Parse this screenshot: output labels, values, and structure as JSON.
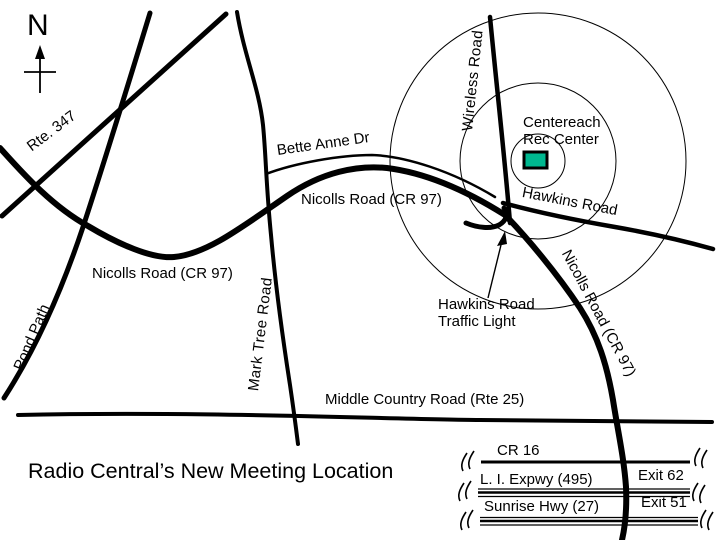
{
  "title": "Radio Central’s New Meeting Location",
  "compass": {
    "north_label": "N"
  },
  "roads": {
    "rte_347": "Rte. 347",
    "pond_path": "Pond Path",
    "mark_tree": "Mark Tree Road",
    "bette_anne": "Bette Anne Dr",
    "nicolls_west": "Nicolls Road (CR 97)",
    "nicolls_center": "Nicolls Road (CR 97)",
    "nicolls_south": "Nicolls Road (CR 97)",
    "wireless": "Wireless Road",
    "hawkins": "Hawkins Road",
    "middle_country": "Middle Country Road (Rte 25)"
  },
  "destination": {
    "name_line1": "Centereach",
    "name_line2": "Rec Center",
    "marker_color": "#00B890"
  },
  "callout": {
    "line1": "Hawkins Road",
    "line2": "Traffic Light"
  },
  "reference_roads": [
    {
      "name": "CR 16",
      "exit": ""
    },
    {
      "name": "L. I. Expwy (495)",
      "exit": "Exit 62"
    },
    {
      "name": "Sunrise Hwy (27)",
      "exit": "Exit 51"
    }
  ]
}
